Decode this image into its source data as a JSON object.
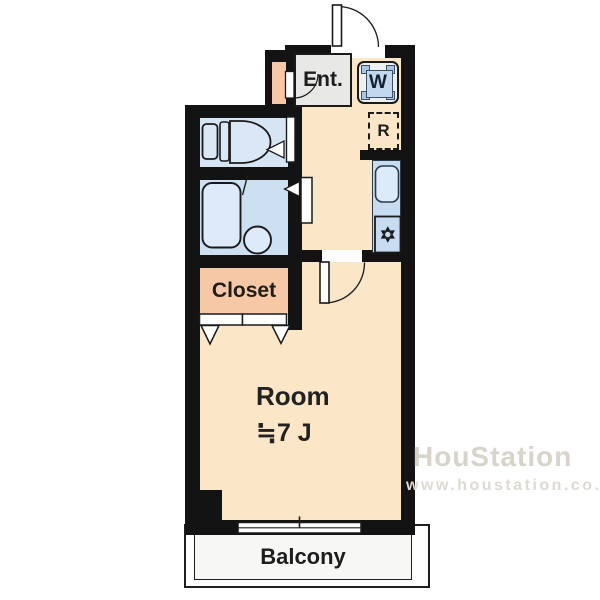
{
  "rooms": {
    "entrance": {
      "label": "Ent."
    },
    "washer": {
      "label": "W"
    },
    "refrigerator": {
      "label": "R"
    },
    "closet": {
      "label": "Closet"
    },
    "main_room": {
      "label": "Room",
      "size": "≒7 J"
    },
    "balcony": {
      "label": "Balcony"
    }
  },
  "watermark": {
    "line1": "HouStation",
    "line2": "www.houstation.co.jp"
  },
  "colors": {
    "wall": "#131313",
    "floor": "#fbe6c7",
    "toilet_room": "#d6e5f3",
    "bathroom": "#cde0f2",
    "closet": "#f6c8a5",
    "entrance": "#e8e8e6",
    "kitchen_counter": "#c7dcf0",
    "fixture_fill": "#dceafa",
    "door_fill": "#ffffff"
  }
}
